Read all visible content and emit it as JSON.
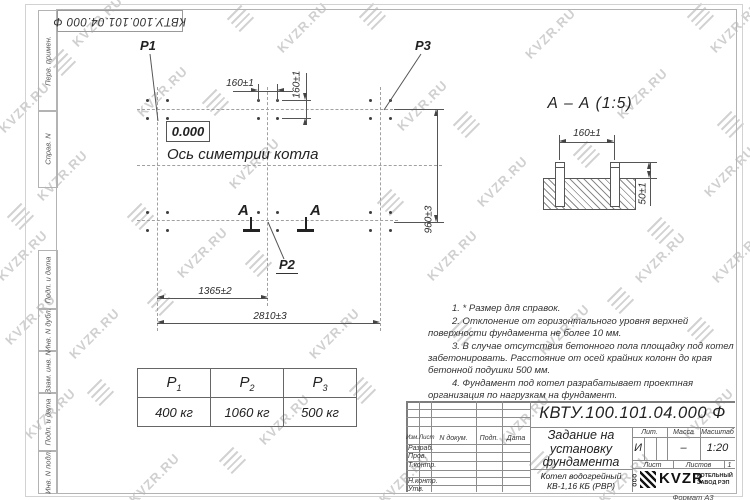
{
  "watermark": {
    "text": "KVZR.RU"
  },
  "corner_stamp": {
    "doc_number": "КВТУ.100.101.04.000  Ф"
  },
  "side_strip": {
    "fields": [
      "Перв. примен.",
      "Справ. N",
      "Подп. и дата",
      "Инв. N дубл.",
      "Взам. инв. N",
      "Подп. и дата",
      "Инв. N подл."
    ]
  },
  "plan": {
    "points": {
      "p1": "P1",
      "p2": "P2",
      "p3": "P3"
    },
    "elevation": "0.000",
    "axis_label": "Ось симетрии котла",
    "section_letter": "А",
    "dims": {
      "bolt_pitch_h": "160±1",
      "bolt_pitch_v": "160±1",
      "row_spacing": "960±3",
      "left_span": "1365±2",
      "total_span": "2810±3"
    }
  },
  "section": {
    "title": "А – А (1:5)",
    "dims": {
      "bolt_spacing": "160±1",
      "protrusion": "50±1"
    }
  },
  "notes": {
    "items": [
      "1. * Размер для справок.",
      "2. Отклонение от горизонтального уровня верхней поверхности фундамента не более 10 мм.",
      "3. В случае отсутствия бетонного пола площадку под котел забетонировать. Расстояние от осей крайних колонн до края бетонной подушки 500 мм.",
      "4. Фундамент под котел разрабатывает проектная организация по нагрузкам на фундамент."
    ]
  },
  "load_table": {
    "columns": [
      {
        "symbol": "P",
        "sub": "1",
        "value": "400 кг"
      },
      {
        "symbol": "P",
        "sub": "2",
        "value": "1060 кг"
      },
      {
        "symbol": "P",
        "sub": "3",
        "value": "500 кг"
      }
    ]
  },
  "title_block": {
    "doc_number": "КВТУ.100.101.04.000  Ф",
    "title_lines": [
      "Задание на",
      "установку",
      "фундамента"
    ],
    "product_lines": [
      "Котел водогрейный",
      "КВ-1,16 КБ (РВР)"
    ],
    "header_cols": {
      "izm": "Изм.",
      "list": "Лист",
      "doc": "N докум.",
      "podp": "Подп.",
      "data": "Дата"
    },
    "sign_rows": {
      "r1": "Разраб.",
      "r2": "Пров.",
      "r3": "Т.контр.",
      "r4": "Н.контр.",
      "r5": "Утв."
    },
    "lit_label": "Лит.",
    "mass_label": "Масса",
    "scale_label": "Масштаб",
    "lit_value": "И",
    "mass_value": "–",
    "scale_value": "1:20",
    "sheet_label": "Лист",
    "sheets_label": "Листов",
    "sheets_value": "1",
    "logo_ooo": "ООО",
    "logo_text": "KVZR",
    "company_lines": [
      "КОТЕЛЬНЫЙ",
      "ЗАВОД РЭП"
    ],
    "format_note": "Формат А3"
  }
}
